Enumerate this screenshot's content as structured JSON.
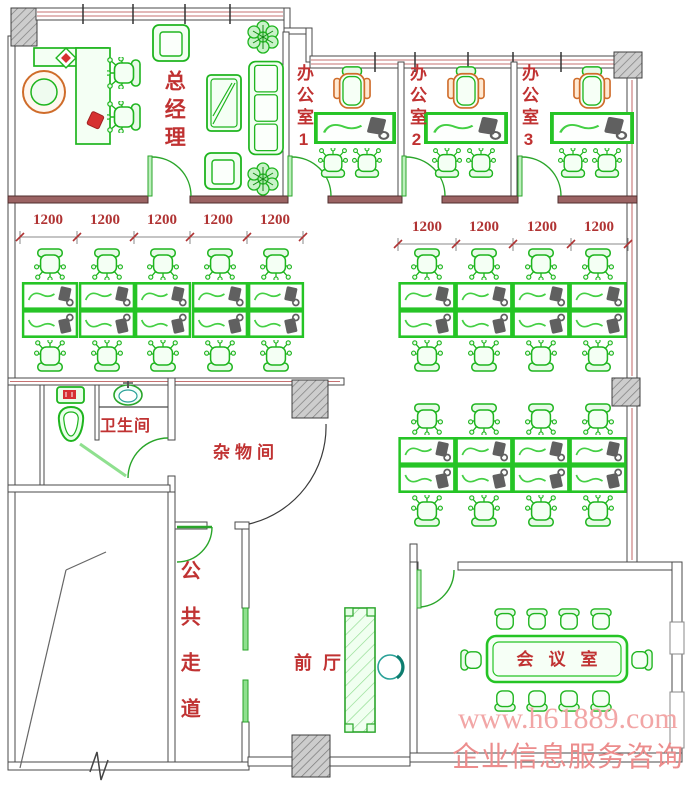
{
  "rooms": {
    "general_manager": "总经理",
    "office1": "办公室1",
    "office2": "办公室2",
    "office3": "办公室3",
    "bathroom": "卫生间",
    "storage": "杂物间",
    "corridor": "公共走道",
    "lobby": "前厅",
    "meeting": "会议室"
  },
  "dims": {
    "left": [
      "1200",
      "1200",
      "1200",
      "1200",
      "1200"
    ],
    "right": [
      "1200",
      "1200",
      "1200",
      "1200"
    ]
  },
  "watermark": {
    "line1": "www.h61889.com",
    "line2": "企业信息服务咨询"
  },
  "colors": {
    "furniture_green": "#1fb51f",
    "desk_border_green": "#25c425",
    "label_red": "#c03232",
    "dimension_red": "#b03333",
    "wall_maroon": "#9b6363",
    "window_red_line": "#c67272",
    "watermark_pink": "#f09e9e",
    "teal_accent": "#2aa198",
    "exec_chair_orange": "#cf6c2a"
  }
}
